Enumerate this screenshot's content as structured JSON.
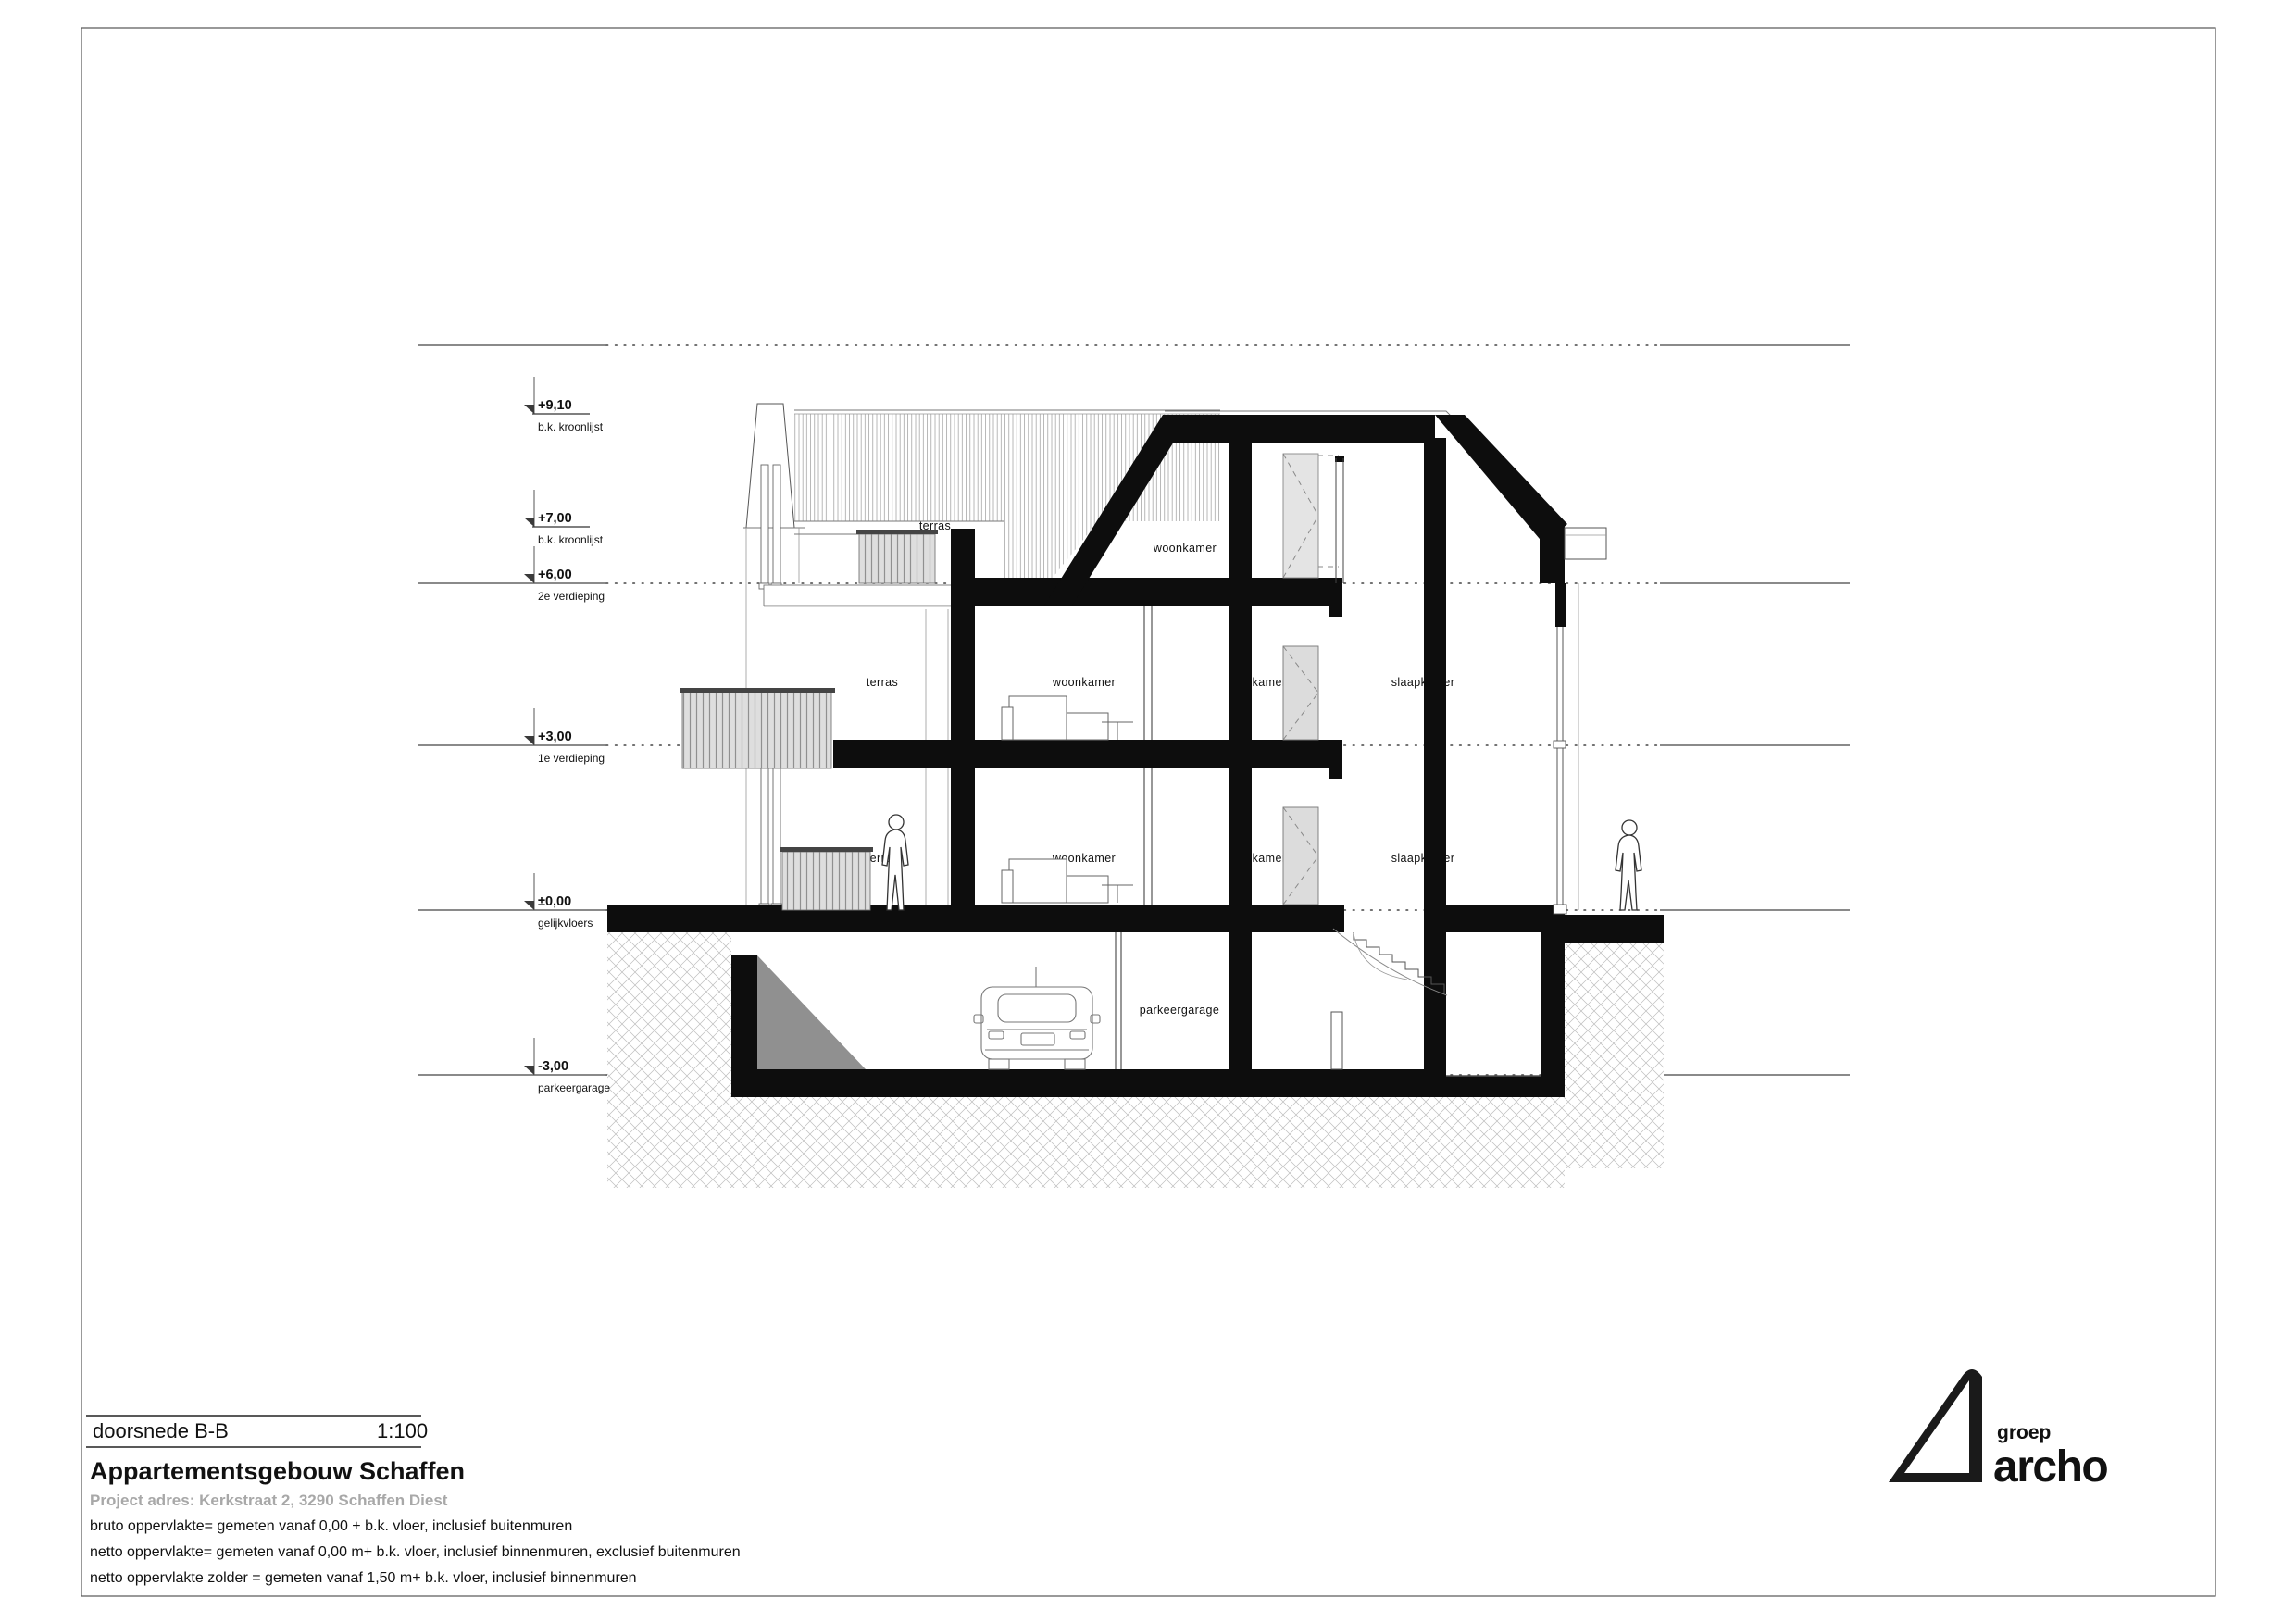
{
  "document": {
    "drawing_name": "doorsnede B-B",
    "scale": "1:100",
    "project_title": "Appartementsgebouw Schaffen",
    "project_address": "Project adres: Kerkstraat 2, 3290 Schaffen Diest",
    "notes": [
      "bruto oppervlakte= gemeten vanaf 0,00 + b.k. vloer, inclusief buitenmuren",
      "netto oppervlakte= gemeten vanaf 0,00 m+ b.k. vloer, inclusief binnenmuren, exclusief buitenmuren",
      "netto oppervlakte zolder = gemeten vanaf 1,50 m+ b.k. vloer, inclusief binnenmuren"
    ]
  },
  "logo": {
    "group": "groep",
    "name": "archo"
  },
  "levels": [
    {
      "value": "+9,10",
      "label": "b.k. kroonlijst"
    },
    {
      "value": "+7,00",
      "label": "b.k. kroonlijst"
    },
    {
      "value": "+6,00",
      "label": "2e verdieping"
    },
    {
      "value": "+3,00",
      "label": "1e verdieping"
    },
    {
      "value": "±0,00",
      "label": "gelijkvloers"
    },
    {
      "value": "-3,00",
      "label": "parkeergarage"
    }
  ],
  "rooms": [
    {
      "name": "terras"
    },
    {
      "name": "woonkamer"
    },
    {
      "name": "terras"
    },
    {
      "name": "woonkamer"
    },
    {
      "name": "kamer"
    },
    {
      "name": "slaapkamer"
    },
    {
      "name": "terras"
    },
    {
      "name": "woonkamer"
    },
    {
      "name": "kamer"
    },
    {
      "name": "slaapkamer"
    },
    {
      "name": "parkeergarage"
    }
  ],
  "colors": {
    "ink": "#111111",
    "cut_fill": "#0d0d0d",
    "glass": "#dcdcdc",
    "ramp_gray": "#909090",
    "muted_text": "#a8a8a8"
  }
}
